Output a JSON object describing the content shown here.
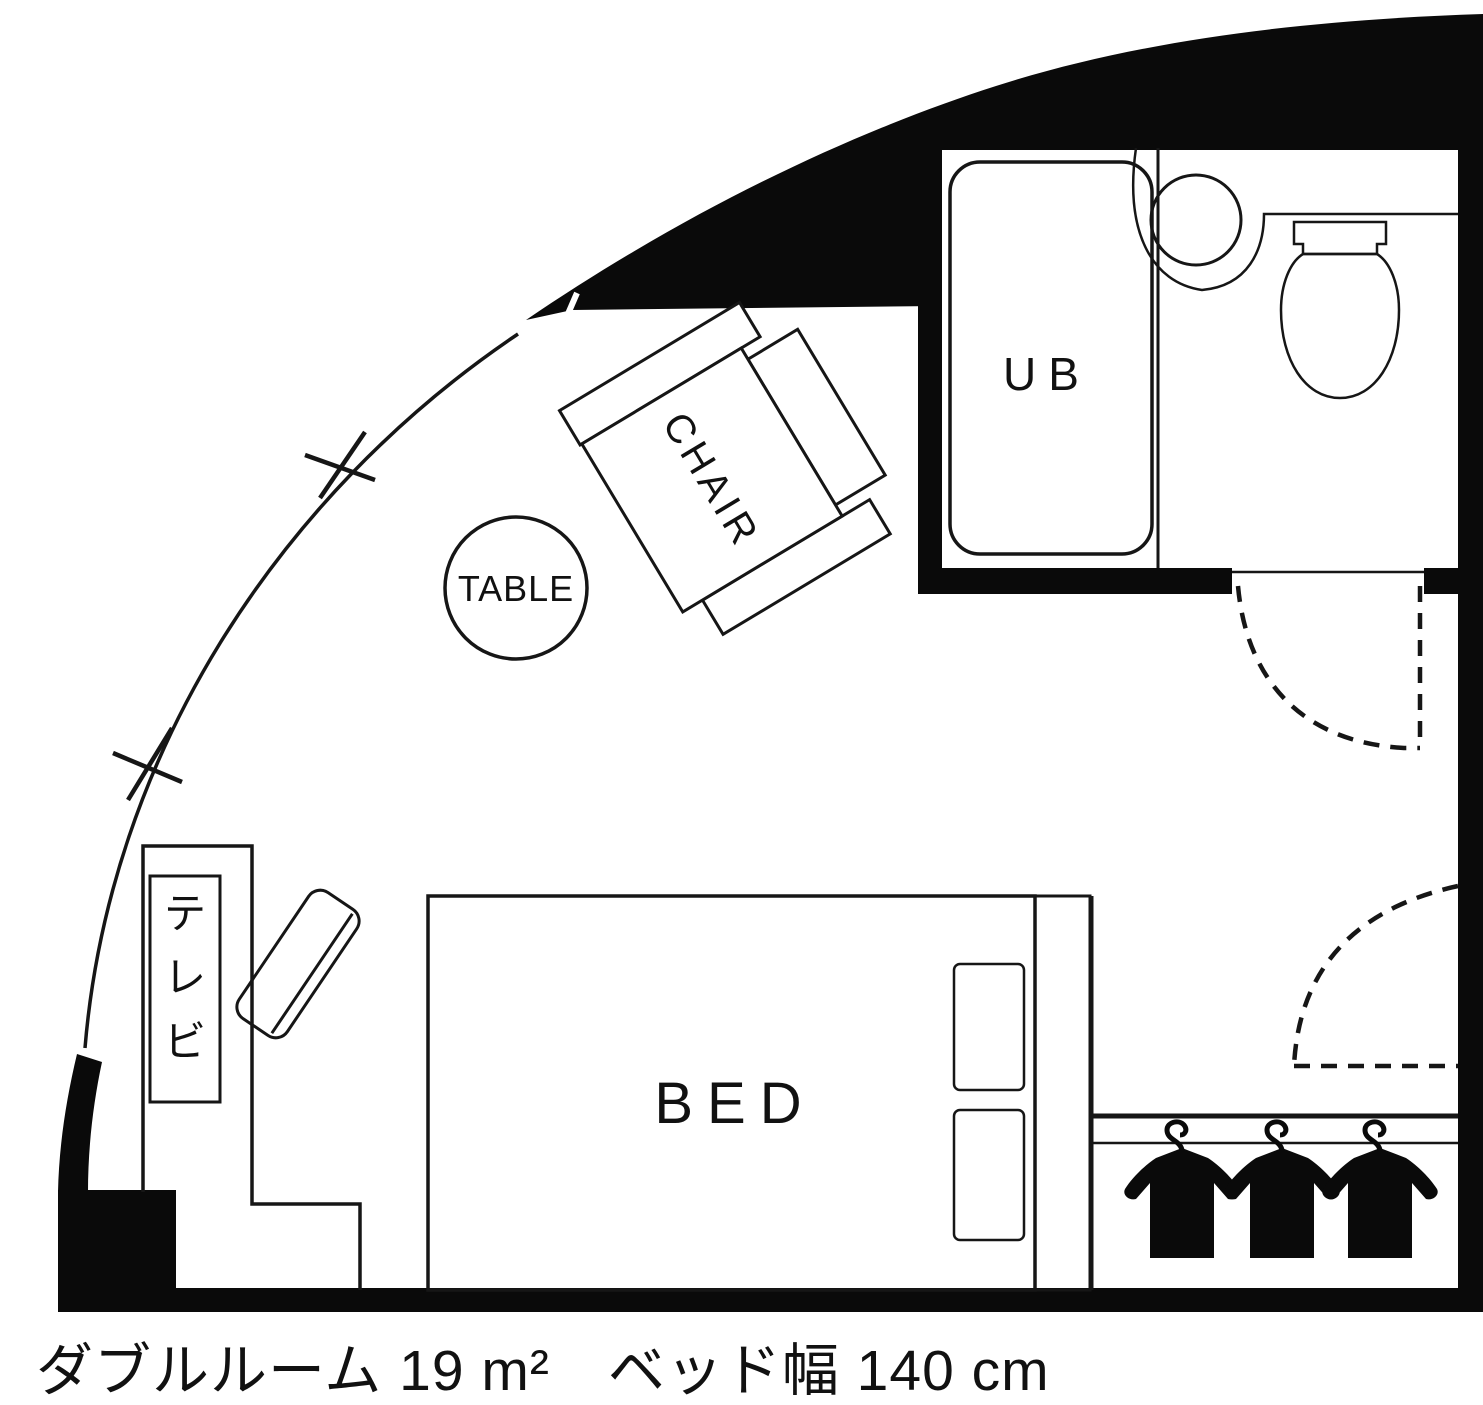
{
  "floorplan": {
    "bathroom": {
      "label": "UB"
    },
    "furniture": {
      "chair": {
        "label": "CHAIR"
      },
      "table": {
        "label": "TABLE"
      },
      "bed": {
        "label": "BED"
      },
      "tv": {
        "label": "テレビ",
        "chars": [
          "テ",
          "レ",
          "ビ"
        ]
      }
    },
    "closet": {
      "hanger_count": 3
    }
  },
  "caption": {
    "room_type": "ダブルルーム",
    "area": "19 m²",
    "bed_width_label": "ベッド幅",
    "bed_width": "140 cm",
    "full_text": "ダブルルーム 19 m²　ベッド幅 140 cm"
  },
  "colors": {
    "ink": "#111111",
    "background": "#ffffff"
  }
}
